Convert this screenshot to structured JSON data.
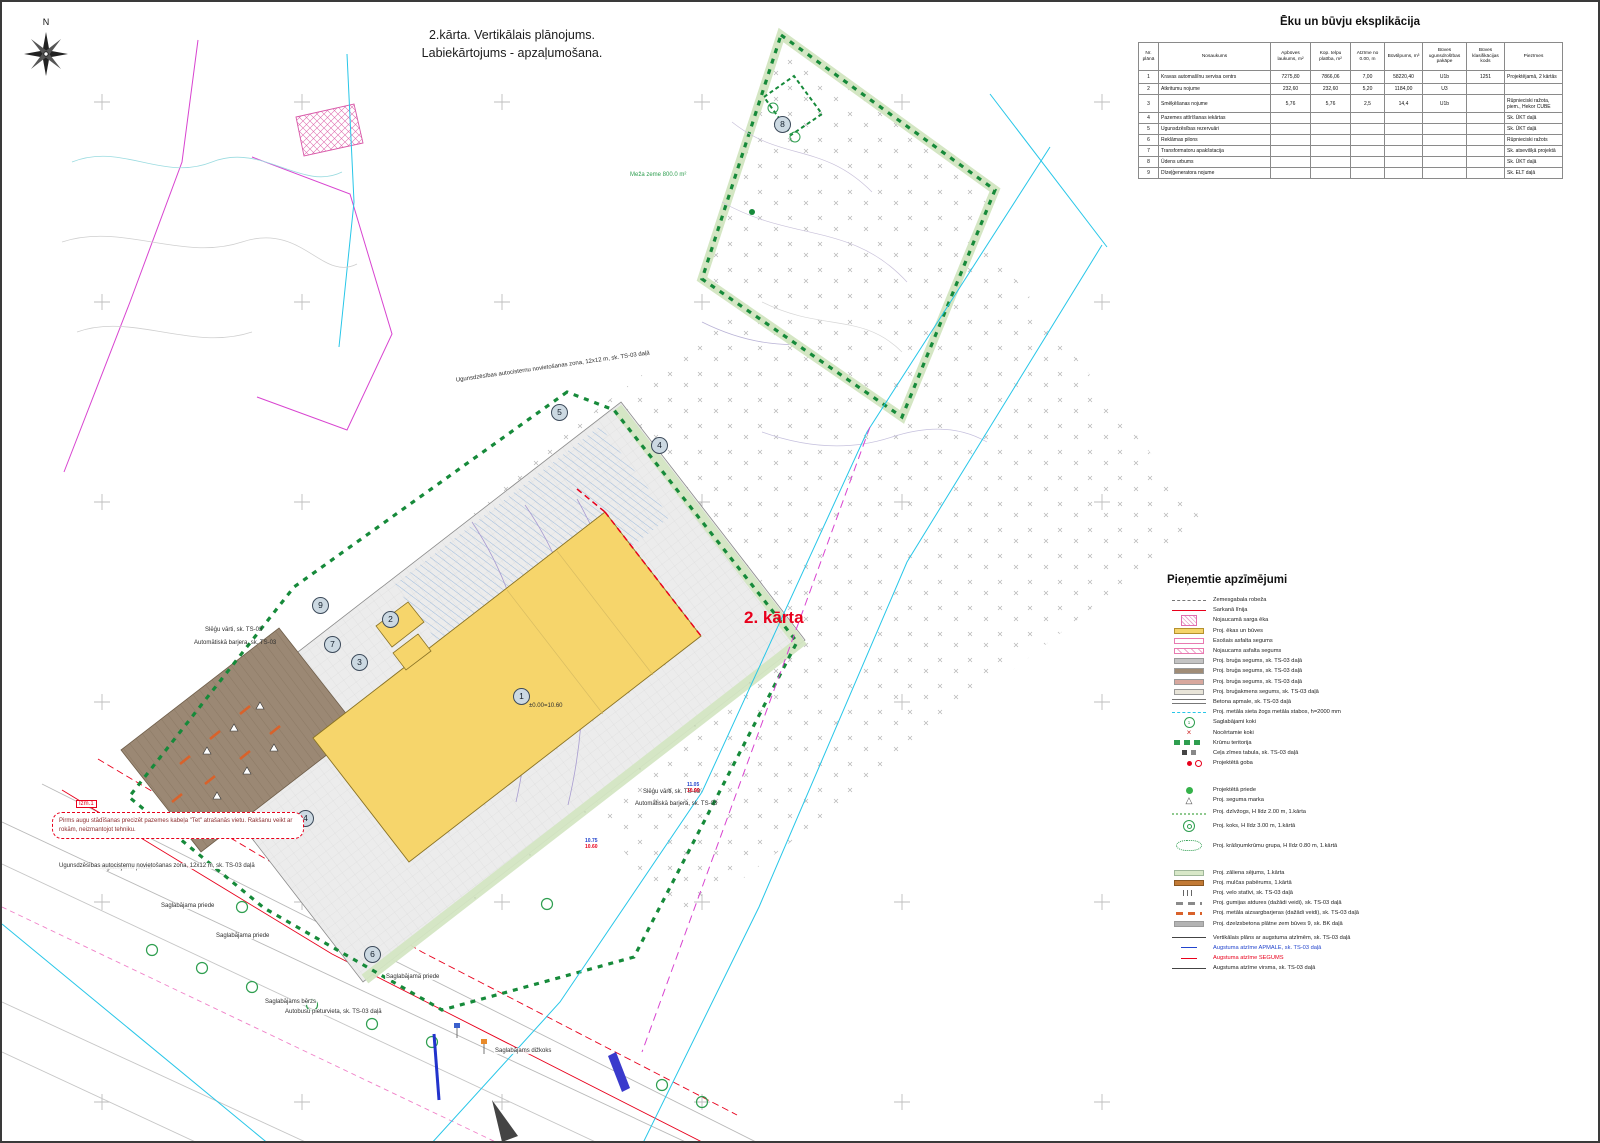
{
  "colors": {
    "accent_red": "#e8001c",
    "boundary_green": "#168a3a",
    "tree_green": "#2e9e4f",
    "building_yellow": "#f6d56b",
    "utility_cyan": "#27c6e8",
    "boundary_magenta": "#d844d0",
    "elevation_blue": "#2244cc"
  },
  "title": {
    "line1": "2.kārta. Vertikālais plānojums.",
    "line2": "Labiekārtojums - apzaļumošana."
  },
  "compass": {
    "label": "N"
  },
  "phase_label": "2. kārta",
  "table": {
    "title": "Ēku un būvju eksplikācija",
    "headers": [
      "Nr. plānā",
      "Nosaukums",
      "Apbūves laukums, m²",
      "Kop. telpu platība, m²",
      "Atzīme no 0.00, m",
      "Būvtilpums, m³",
      "Būves ugunsdrošības pakāpe",
      "Būves klasifikācijas kods",
      "Piezīmes"
    ],
    "rows": [
      [
        "1",
        "Kravas automašīnu servisa centrs",
        "7275,80",
        "7866,06",
        "7,00",
        "58220,40",
        "U1b",
        "1251",
        "Projektējamā, 2 kārtās"
      ],
      [
        "2",
        "Atkritumu nojume",
        "232,60",
        "232,60",
        "5,20",
        "1184,00",
        "U3",
        "",
        ""
      ],
      [
        "3",
        "Smēķēšanas nojume",
        "5,76",
        "5,76",
        "2,5",
        "14,4",
        "U1b",
        "",
        "Rūpnieciski ražota, piem., Hekor CUBE"
      ],
      [
        "4",
        "Pazemes attīrīšanas iekārtas",
        "",
        "",
        "",
        "",
        "",
        "",
        "Sk. ŪKT daļā"
      ],
      [
        "5",
        "Ugunsdzēsības rezervuāri",
        "",
        "",
        "",
        "",
        "",
        "",
        "Sk. ŪKT daļā"
      ],
      [
        "6",
        "Reklāmas pilons",
        "",
        "",
        "",
        "",
        "",
        "",
        "Rūpnieciski ražots"
      ],
      [
        "7",
        "Transformatoru apakšstacija",
        "",
        "",
        "",
        "",
        "",
        "",
        "Sk. atsevišķā projektā"
      ],
      [
        "8",
        "Ūdens urbums",
        "",
        "",
        "",
        "",
        "",
        "",
        "Sk. ŪKT daļā"
      ],
      [
        "9",
        "Dīzeļģeneratora nojume",
        "",
        "",
        "",
        "",
        "",
        "",
        "Sk. ELT daļā"
      ]
    ]
  },
  "legend": {
    "title": "Pieņemtie apzīmējumi",
    "items": [
      "Zemesgabala robeža",
      "Sarkanā līnija",
      "Nojaucamā sarga ēka",
      "Proj. ēkas un būves",
      "Esošais asfalta segums",
      "Nojaucams asfalta segums",
      "Proj. bruģa segums, sk. TS-03 daļā",
      "Proj. bruģa segums, sk. TS-03 daļā",
      "Proj. bruģa segums, sk. TS-03 daļā",
      "Proj. bruģakmens segums, sk. TS-03 daļā",
      "Betona apmale, sk. TS-03 daļā",
      "Proj. metāla sieta žogs metāla stabos, h=2000 mm",
      "Saglabājami koki",
      "Nocērtamie koki",
      "Krūmu teritorija",
      "Ceļa zīmes tabula, sk. TS-03 daļā",
      "Projektētā goba",
      "Projektētā priede",
      "Proj. seguma marka",
      "Proj. dzīvžogs, H līdz 2.00 m, 1.kārta",
      "Proj. koks, H līdz 3.00 m, 1.kārtā",
      "Proj. krāšņumkrūmu grupa, H līdz 0.80 m, 1.kārtā",
      "Proj. zāliena sējums, 1.kārta",
      "Proj. mulčas pabērums, 1.kārtā",
      "Proj. velo statīvi, sk. TS-03 daļā",
      "Proj. gumijas atdures (dažādi veidi), sk. TS-03 daļā",
      "Proj. metāla aizsargbarjeras (dažādi veidi), sk. TS-03 daļā",
      "Proj. dzelzsbetona plātne zem būves 9, sk. BK daļā",
      "Vertikālais plāns ar augstuma atzīmēm, sk. TS-03 daļā",
      "Augstuma atzīme APMALE, sk. TS-03 daļā",
      "Augstuma atzīme SEGUMS",
      "Augstuma atzīme virsma, sk. TS-03 daļā"
    ]
  },
  "plan": {
    "labels": [
      "Ugunsdzēsības autocisternu novietošanas zona, 12x12 m, sk. TS-03 daļā",
      "Meža zeme 800.0 m²",
      "Slēģu vārti, sk. TS-03",
      "Automātiskā barjera, sk. TS-03",
      "Slēģu vārti, sk. TS-03",
      "Automātiskā barjera, sk. TS-03",
      "Saglabājama priede",
      "Saglabājama priede",
      "Saglabājama priede",
      "Saglabājama priede",
      "Saglabājams bērzs",
      "Saglabājams dižkoks",
      "Ugunsdzēsības autocisternu novietošanas zona, 12x12 m, sk. TS-03 daļā",
      "Autobusu pieturvieta, sk. TS-03 daļā",
      "±0.00=10.60"
    ],
    "markers": [
      "1",
      "2",
      "3",
      "4",
      "5",
      "6",
      "7",
      "8",
      "9",
      "4"
    ],
    "elevations": [
      {
        "blue": "10.75",
        "red": "10.60"
      },
      {
        "blue": "11.05",
        "red": "10.90"
      }
    ],
    "callout": {
      "tag": "Izm.1",
      "text": "Pirms augu stādīšanas precizēt pazemes kabeļa \"Tet\" atrašanās vietu. Rakšanu veikt ar rokām, neizmantojot tehniku."
    }
  }
}
